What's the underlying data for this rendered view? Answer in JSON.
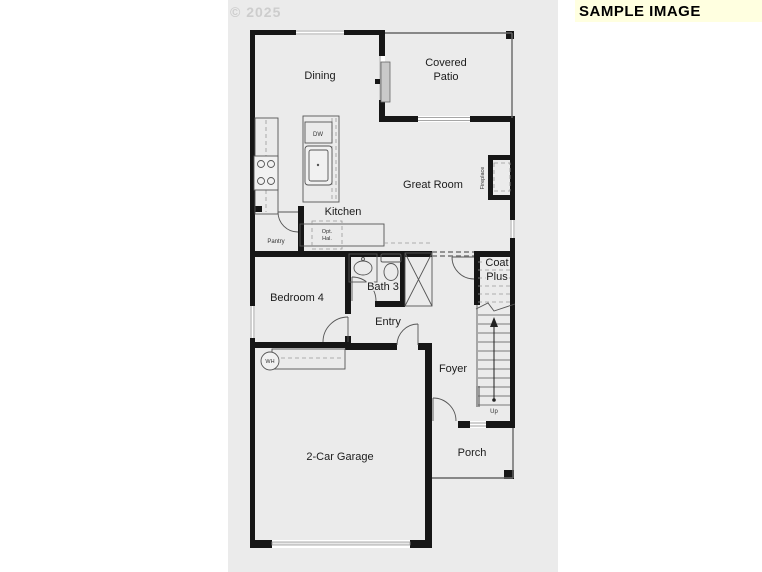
{
  "page": {
    "watermark": "© 2025",
    "sample_badge": "SAMPLE IMAGE"
  },
  "rooms": {
    "dining": "Dining",
    "covered_patio_line1": "Covered",
    "covered_patio_line2": "Patio",
    "great_room": "Great Room",
    "kitchen": "Kitchen",
    "bedroom_4": "Bedroom 4",
    "bath_3": "Bath 3",
    "entry": "Entry",
    "foyer": "Foyer",
    "garage": "2-Car Garage",
    "porch": "Porch",
    "coat_plus_line1": "Coat",
    "coat_plus_line2": "Plus"
  },
  "annotations": {
    "pantry": "Pantry",
    "dishwasher": "DW",
    "opt_hall_line1": "Opt.",
    "opt_hall_line2": "Hal.",
    "water_heater": "WH",
    "fireplace": "Fireplace",
    "stairs_up": "Up"
  },
  "colors": {
    "scan_background": "#ebebeb",
    "wall": "#161616",
    "badge_background": "#ffffe0",
    "badge_text": "#000000",
    "watermark_text": "#cdcdcd"
  }
}
